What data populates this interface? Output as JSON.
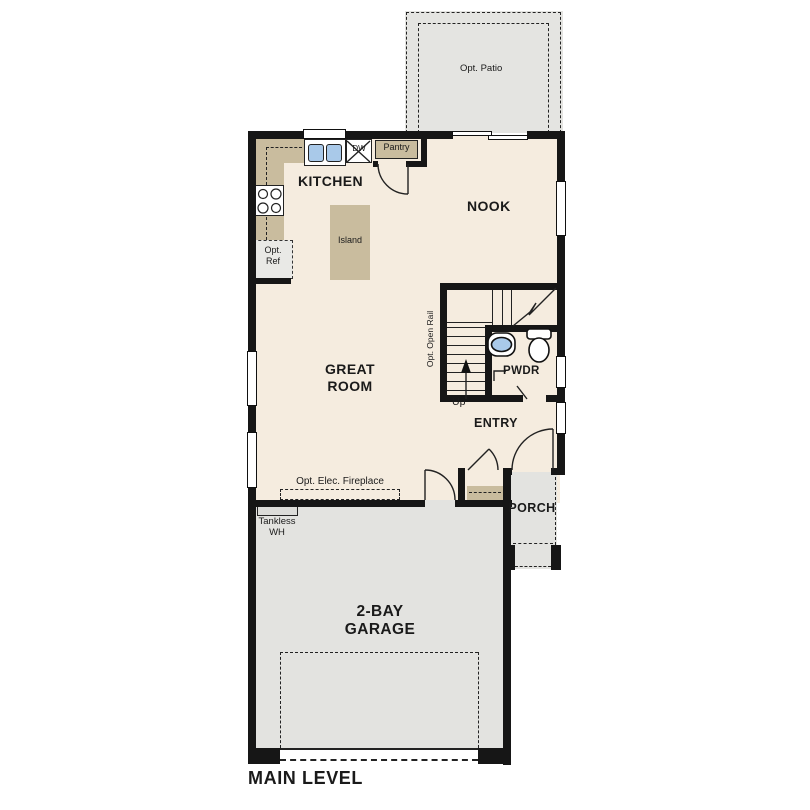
{
  "plan": {
    "title": "MAIN LEVEL",
    "rooms": {
      "kitchen": "KITCHEN",
      "nook": "NOOK",
      "great_room": [
        "GREAT",
        "ROOM"
      ],
      "entry": "ENTRY",
      "powder": "PWDR",
      "porch": "PORCH",
      "garage": [
        "2-BAY",
        "GARAGE"
      ]
    },
    "features": {
      "opt_patio": "Opt. Patio",
      "pantry": "Pantry",
      "dishwasher": "DW",
      "island": "Island",
      "opt_ref": [
        "Opt.",
        "Ref"
      ],
      "opt_open_rail": "Opt. Open Rail",
      "stairs_up": "Up",
      "opt_elec_fireplace": "Opt. Elec. Fireplace",
      "tankless_wh": [
        "Tankless",
        "WH"
      ]
    },
    "colors": {
      "wall": "#161616",
      "floor": "#f5ecdf",
      "counter": "#c9bc9e",
      "garage": "#e3e3e0",
      "patio": "#e4e4e1",
      "accent_blue": "#a9c9e9",
      "text": "#1a1a1a"
    }
  }
}
